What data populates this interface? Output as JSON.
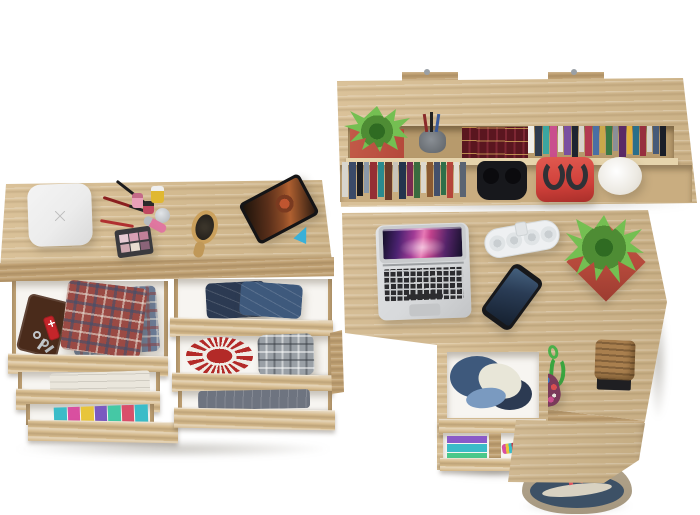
{
  "meta": {
    "description": "3D product render, top view: teen room furniture set in light sonoma-oak — wall shelf with books, double dresser with open drawers of folded clothes and accessories, desk with laptop and under-desk drawer unit",
    "background": "#ffffff"
  },
  "colors": {
    "wood-base": "#d6bb8e",
    "wood-dark": "#c1a274",
    "wood-light": "#e6d4ac",
    "recess-upper": "#b79a6c",
    "recess-lower": "#c9ad80",
    "drawer-interior": "#f7f5f1",
    "laptop-silver": "#d7d9db",
    "laptop-key": "#2c2c2f",
    "planter-red": "#b5493b",
    "plant-dark": "#2f6b22",
    "plant-mid": "#4e8c34",
    "plant-light": "#74bf52",
    "bag-red": "#d0403a",
    "handle-dark": "#2f3136",
    "denim": "#3e597c",
    "denim-dark": "#2c3a52",
    "doily-red": "#b32a28",
    "towel": "#eae6dc",
    "strap-red": "#e05560",
    "duffel-navy": "#3d5166",
    "duffel-beige": "#b3a58d",
    "basket-tan": "#a97f4e",
    "toy-green": "#3aa53f",
    "phone-dark": "#17181b",
    "tablet-dark": "#141416",
    "white-box": "#ececec",
    "plaid-red": "#9a4a44",
    "plaid-blue": "#6a7a94",
    "plaid-gray": "#9aa0a6",
    "jeans-gray": "#6e7480",
    "wallet-brown": "#4a2b1b",
    "knife-red": "#c4252a",
    "redbook": "#5a161f"
  },
  "shelf": {
    "label": "Wall-mounted oak shelf, top view: plant in red pot, pen cup, red leather book set, paperbacks, headphones, red handbag, white bowl planter",
    "upper_books": [
      {
        "c": "#f0eee8",
        "w": 6,
        "h": 85
      },
      {
        "c": "#2e3a4c",
        "w": 7,
        "h": 95
      },
      {
        "c": "#3aa6a0",
        "w": 6,
        "h": 88
      },
      {
        "c": "#c94f8e",
        "w": 7,
        "h": 98
      },
      {
        "c": "#e8e4dc",
        "w": 5,
        "h": 82
      },
      {
        "c": "#7a4fa0",
        "w": 7,
        "h": 92
      },
      {
        "c": "#1e2430",
        "w": 6,
        "h": 96
      },
      {
        "c": "#d8d4cc",
        "w": 5,
        "h": 80
      },
      {
        "c": "#b23a50",
        "w": 7,
        "h": 94
      },
      {
        "c": "#4a6fa5",
        "w": 6,
        "h": 90
      },
      {
        "c": "#caa84a",
        "w": 5,
        "h": 84
      },
      {
        "c": "#3a7a46",
        "w": 6,
        "h": 92
      },
      {
        "c": "#8a8f98",
        "w": 5,
        "h": 78
      },
      {
        "c": "#5a2a66",
        "w": 7,
        "h": 96
      },
      {
        "c": "#e2b13c",
        "w": 5,
        "h": 86
      },
      {
        "c": "#2a6f8a",
        "w": 6,
        "h": 90
      },
      {
        "c": "#972f3e",
        "w": 6,
        "h": 95
      },
      {
        "c": "#d5d2c8",
        "w": 5,
        "h": 82
      },
      {
        "c": "#465a78",
        "w": 6,
        "h": 88
      },
      {
        "c": "#1a1e28",
        "w": 6,
        "h": 93
      }
    ],
    "lower_books": [
      {
        "c": "#d8d5cd",
        "w": 6,
        "h": 90
      },
      {
        "c": "#3a4a68",
        "w": 7,
        "h": 96
      },
      {
        "c": "#1c1e24",
        "w": 6,
        "h": 88
      },
      {
        "c": "#8a98a8",
        "w": 5,
        "h": 80
      },
      {
        "c": "#952f34",
        "w": 7,
        "h": 95
      },
      {
        "c": "#2a8a8f",
        "w": 6,
        "h": 90
      },
      {
        "c": "#6b3a2a",
        "w": 7,
        "h": 98
      },
      {
        "c": "#c8c4ba",
        "w": 5,
        "h": 78
      },
      {
        "c": "#24344d",
        "w": 7,
        "h": 94
      },
      {
        "c": "#7a2a50",
        "w": 6,
        "h": 88
      },
      {
        "c": "#3a6b3f",
        "w": 6,
        "h": 92
      },
      {
        "c": "#dcd8ce",
        "w": 5,
        "h": 80
      },
      {
        "c": "#8a5a32",
        "w": 6,
        "h": 90
      },
      {
        "c": "#44506b",
        "w": 6,
        "h": 86
      },
      {
        "c": "#2f6f4a",
        "w": 5,
        "h": 84
      },
      {
        "c": "#b5453a",
        "w": 6,
        "h": 92
      },
      {
        "c": "#e2ddd2",
        "w": 5,
        "h": 80
      },
      {
        "c": "#5a6472",
        "w": 6,
        "h": 90
      }
    ]
  },
  "dresser": {
    "label": "Oak dressing chest, top view: white box, makeup set, hairbrush, tablet on stand; open drawers with wallet, pocket knife, keys, plaid shirts, jeans, towels, red doily and folded clothes",
    "palette_pans": [
      {
        "c": "#e8ccd4",
        "w": 9,
        "h": 40
      },
      {
        "c": "#d8a0b4",
        "w": 9,
        "h": 40
      },
      {
        "c": "#c08098",
        "w": 9,
        "h": 40
      },
      {
        "c": "#cfa8b0",
        "w": 9,
        "h": 40
      },
      {
        "c": "#e8dcd0",
        "w": 9,
        "h": 40
      },
      {
        "c": "#8a6478",
        "w": 9,
        "h": 40
      }
    ],
    "clothes_drawer3": [
      "#3bbcc8",
      "#d94fa0",
      "#e8c53a",
      "#7a5ac0",
      "#45c8a5",
      "#d94f6a",
      "#3bbcc8"
    ]
  },
  "desk": {
    "label": "Oak desk, top view: open laptop with aurora wallpaper, white power strip, smartphone, succulent in red square planter, green cord toy, beaded pouch, wicker basket",
    "pedestal_label": "Under-desk drawer unit: open drawer with denim pile, lower compartments with folded clothes",
    "pedestal_clothes": [
      "#8a5ac8",
      "#3bbcc8",
      "#4ac88a"
    ]
  },
  "floor": {
    "bag_label": "Canvas duffel bag, navy and beige with red straps, on floor beside desk"
  }
}
